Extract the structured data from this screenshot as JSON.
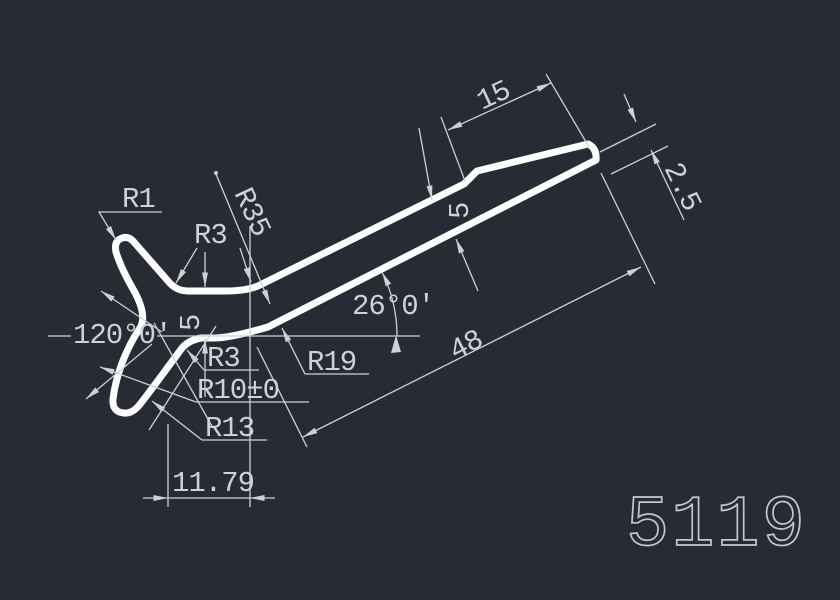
{
  "canvas": {
    "background_color": "#262b34",
    "profile_color": "#ffffff",
    "dimension_color": "#ccd0d7",
    "description": "CAD profile drawing of a forked contact strip with angled bar and stepped flange end"
  },
  "drawing_number": "5119",
  "dimensions": {
    "r1": "R1",
    "r3_top": "R3",
    "r35_rotated": "R35",
    "angle_left": "120°0'",
    "stem_thickness": "5",
    "r3_bottom": "R3",
    "r10_tol": "R10±0",
    "r13": "R13",
    "r19": "R19",
    "bar_angle": "26°0'",
    "bar_length": "48",
    "flange_length": "15",
    "step_height": "5",
    "flange_thickness": "2.5",
    "base_width": "11.79"
  }
}
